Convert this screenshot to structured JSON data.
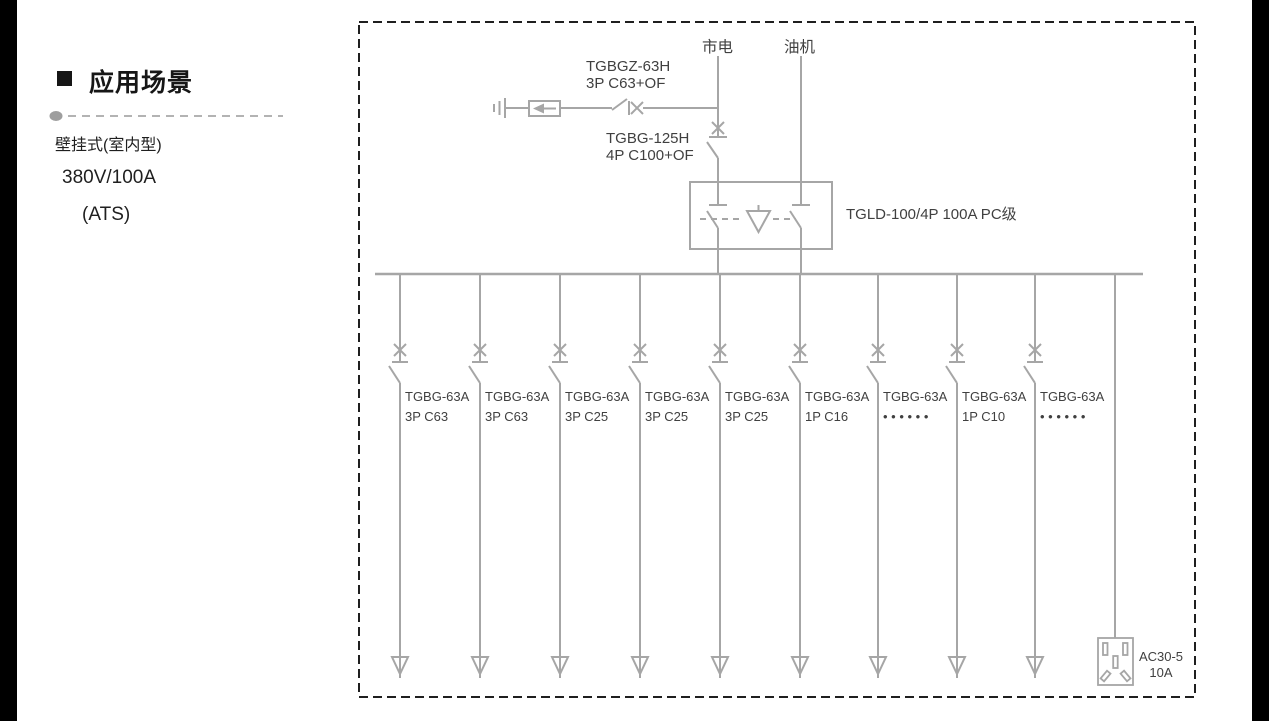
{
  "left_panel": {
    "heading": "应用场景",
    "items": [
      "壁挂式(室内型)",
      "380V/100A",
      "(ATS)"
    ]
  },
  "diagram": {
    "mains_label": "市电",
    "generator_label": "油机",
    "spd_breaker": {
      "model": "TGBGZ-63H",
      "spec": "3P C63+OF"
    },
    "main_breaker": {
      "model": "TGBG-125H",
      "spec": "4P C100+OF"
    },
    "ats_label": "TGLD-100/4P 100A PC级",
    "branches": [
      {
        "model": "TGBG-63A",
        "spec": "3P C63"
      },
      {
        "model": "TGBG-63A",
        "spec": "3P C63"
      },
      {
        "model": "TGBG-63A",
        "spec": "3P C25"
      },
      {
        "model": "TGBG-63A",
        "spec": "3P C25"
      },
      {
        "model": "TGBG-63A",
        "spec": "3P C25"
      },
      {
        "model": "TGBG-63A",
        "spec": "1P C16"
      },
      {
        "model": "TGBG-63A",
        "spec": "• • • • • •"
      },
      {
        "model": "TGBG-63A",
        "spec": "1P C10"
      },
      {
        "model": "TGBG-63A",
        "spec": "• • • • • •"
      }
    ],
    "socket": {
      "model": "AC30-5",
      "rating": "10A"
    },
    "colors": {
      "line": "#a6a6a6",
      "text": "#404040",
      "border": "#1f1f1f"
    }
  }
}
